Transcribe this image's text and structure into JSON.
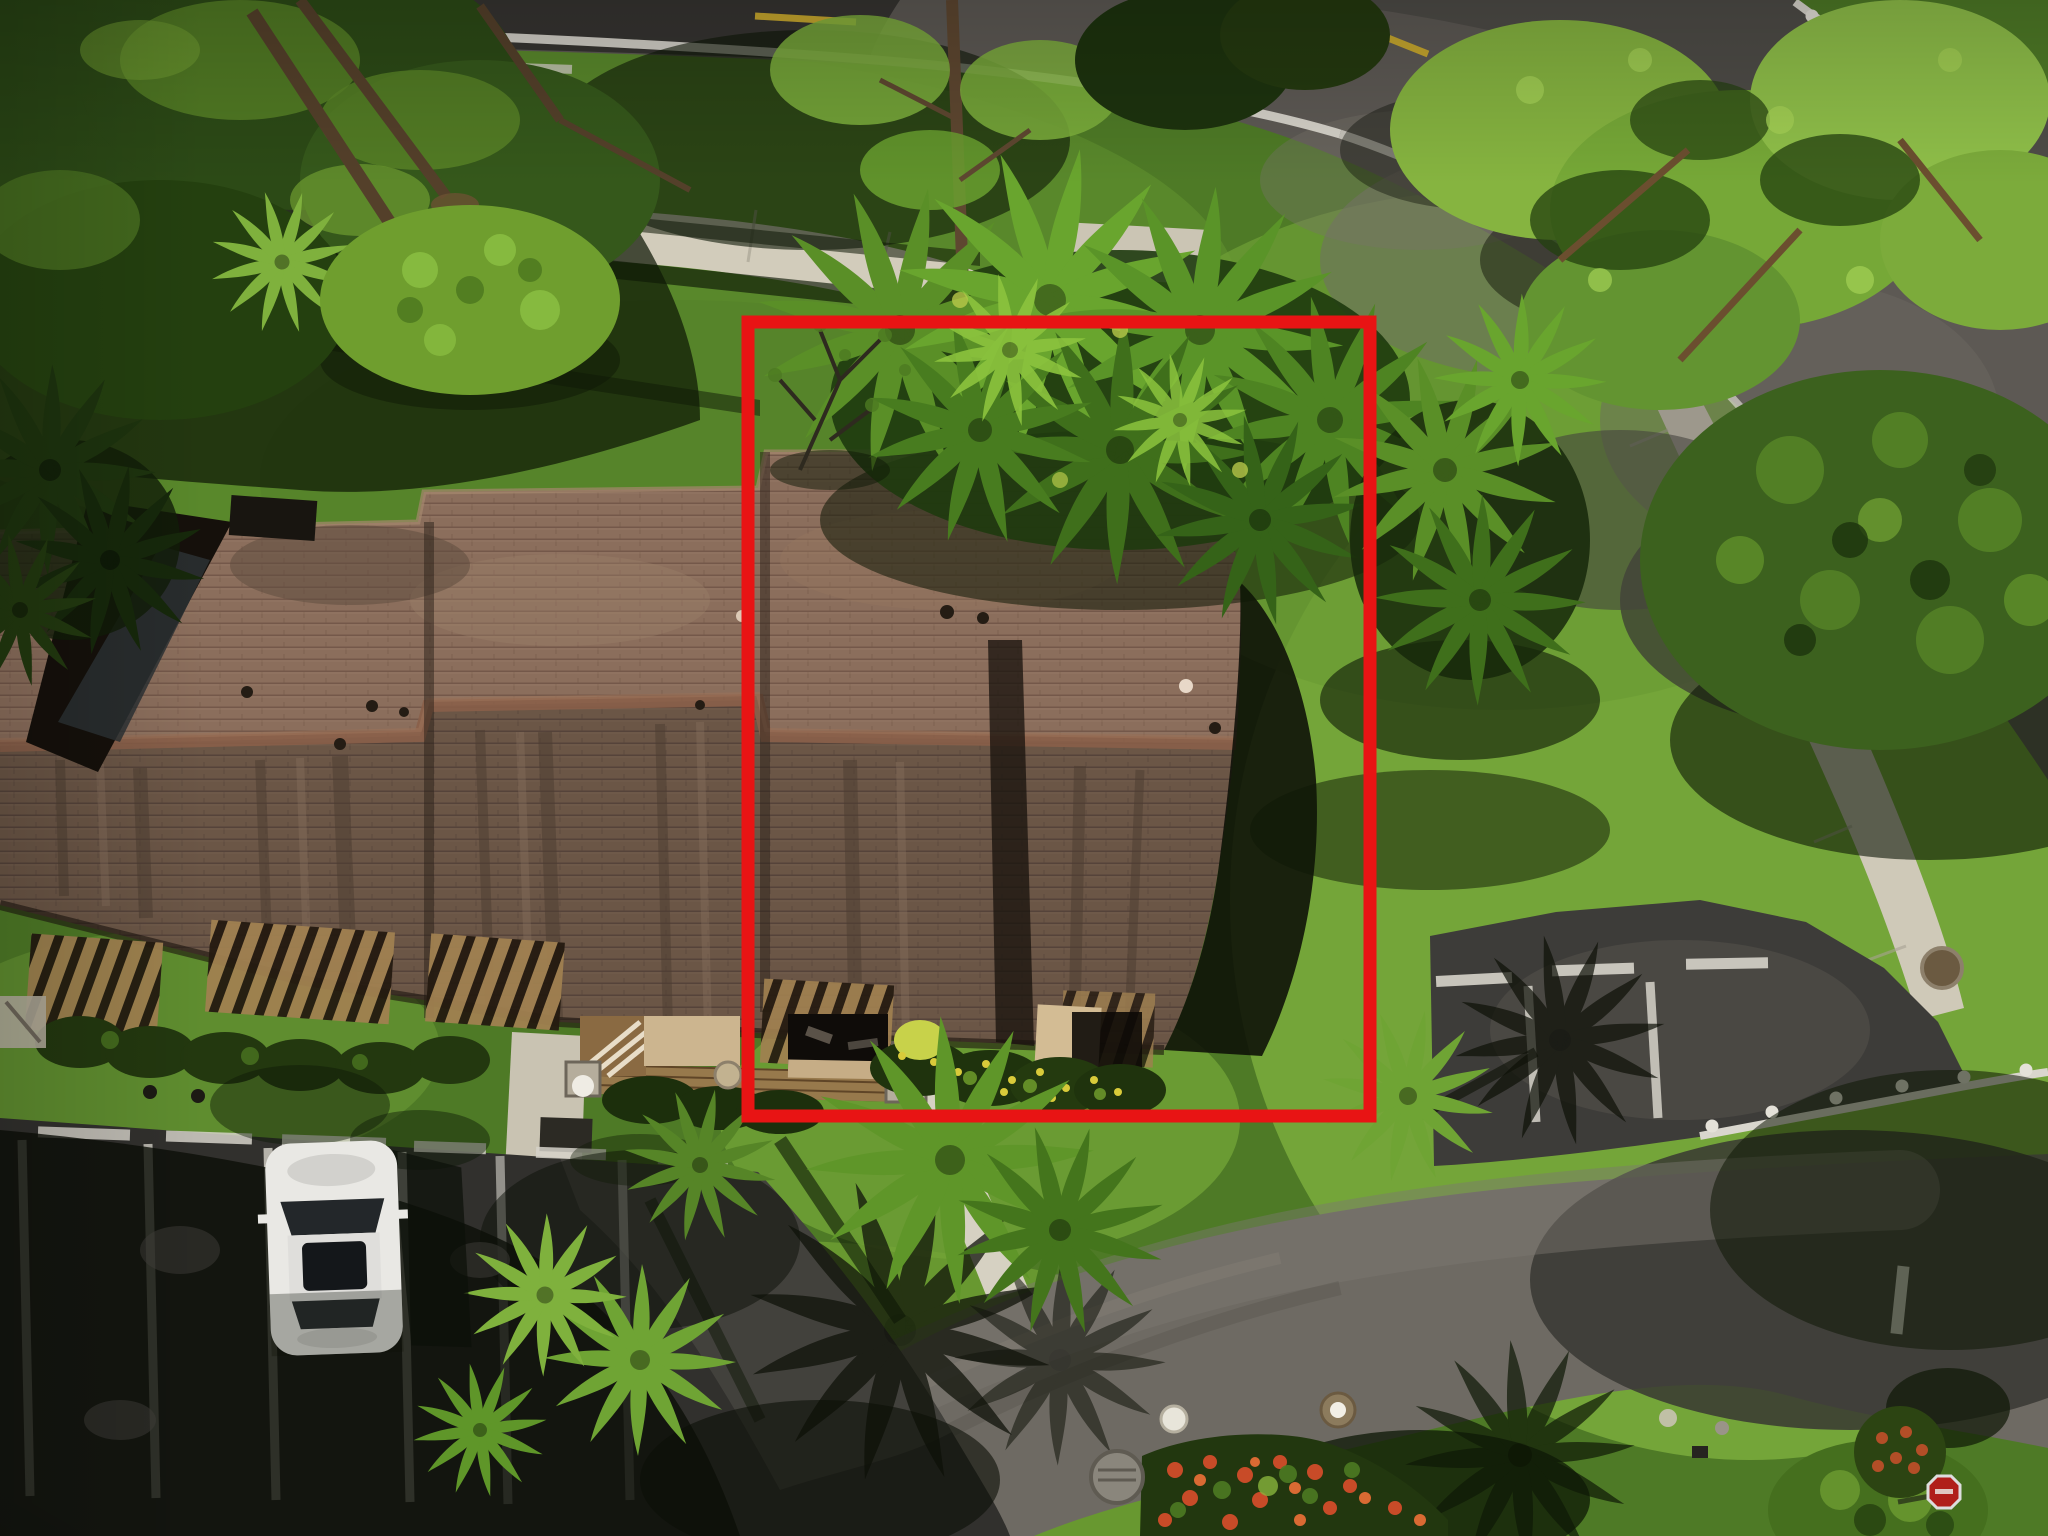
{
  "meta": {
    "kind": "aerial-drone-photograph",
    "description": "Overhead drone photo of a one-story multi-unit residential building with brown shingle roofs, set among lawns, palm and pine trees, concrete walkways, two parking lots with white stall stripes, a white car, and curving asphalt roads; a red rectangle annotation outlines the featured unit and its yard.",
    "text_present": false
  },
  "annotation": {
    "shape": "rectangle",
    "color": "#e81414",
    "stroke_width_px": 13,
    "bounds_px": {
      "x": 748,
      "y": 322,
      "width": 622,
      "height": 794
    },
    "bounds_pct": {
      "left": 36.5,
      "top": 21.0,
      "width": 30.4,
      "height": 51.7
    },
    "purpose": "highlights the featured unit and its yard"
  },
  "scene": {
    "elements": [
      "brown-shingle-roof-building",
      "red-annotation-rectangle",
      "palm-canopy-over-roof",
      "pine-trees-top-left",
      "pine-trees-top-right",
      "large-leafy-tree-right",
      "curving-sidewalks",
      "top-road-and-intersection",
      "curving-bottom-road",
      "bottom-left-parking-lot-with-white-car",
      "right-parking-stalls",
      "courtyard-pergolas-and-decks",
      "flower-bed-median-with-red-flowers",
      "stop-sign-bottom-right",
      "tree-shadows-on-grass-and-asphalt"
    ],
    "palette": {
      "annotation_red": "#e81414",
      "roof_sunlit": "#8b6e5c",
      "roof_shaded": "#6b5646",
      "grass": "#5d8e2e",
      "grass_shadow": "#0e1806",
      "asphalt_dark": "#31302d",
      "asphalt_worn": "#6e6a63",
      "concrete": "#d2ccbb",
      "marking_white": "#dedbd2",
      "car_white": "#e9e8e4",
      "palm_green": "#69a52e",
      "pine_green": "#86b440",
      "flower_red": "#c84b28"
    }
  }
}
